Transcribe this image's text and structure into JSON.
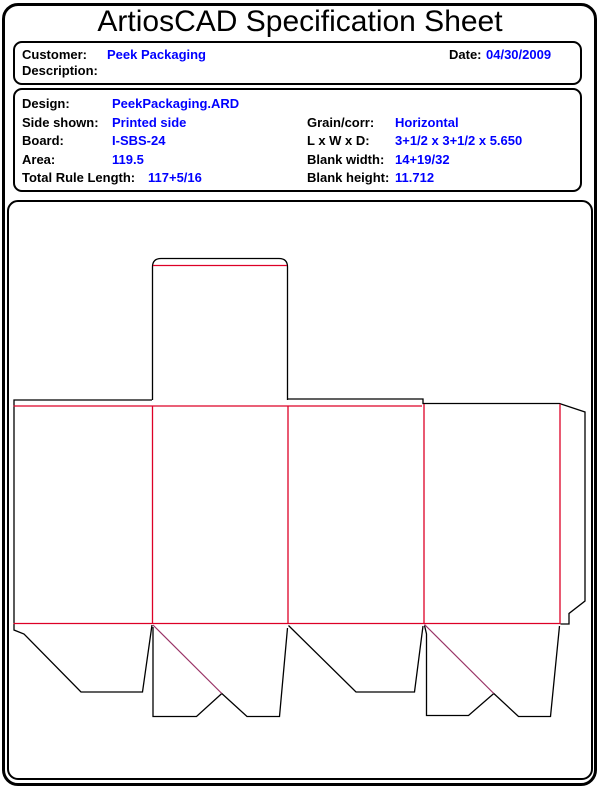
{
  "page": {
    "title": "ArtiosCAD Specification Sheet"
  },
  "customer_box": {
    "customer_label": "Customer:",
    "customer_value": "Peek Packaging",
    "date_label": "Date:",
    "date_value": "04/30/2009",
    "description_label": "Description:",
    "description_value": ""
  },
  "spec_box": {
    "left_rows": [
      {
        "label": "Design:",
        "value": "PeekPackaging.ARD"
      },
      {
        "label": "Side shown:",
        "value": "Printed side"
      },
      {
        "label": "Board:",
        "value": "I-SBS-24"
      },
      {
        "label": "Area:",
        "value": "119.5"
      },
      {
        "label": "Total Rule Length:",
        "value": "117+5/16"
      }
    ],
    "right_rows": [
      {
        "label": "Grain/corr:",
        "value": "Horizontal"
      },
      {
        "label": "L x W x D:",
        "value": "3+1/2 x 3+1/2 x 5.650"
      },
      {
        "label": "Blank width:",
        "value": "14+19/32"
      },
      {
        "label": "Blank height:",
        "value": "11.712"
      }
    ]
  },
  "drawing": {
    "type": "carton-dieline-flat-blank",
    "cut_color": "#000000",
    "crease_color": "#dd0026",
    "diagonal_crease_color": "#993366"
  },
  "colors": {
    "value_text": "#0000ff",
    "label_text": "#000000",
    "border": "#000000",
    "background": "#ffffff"
  }
}
